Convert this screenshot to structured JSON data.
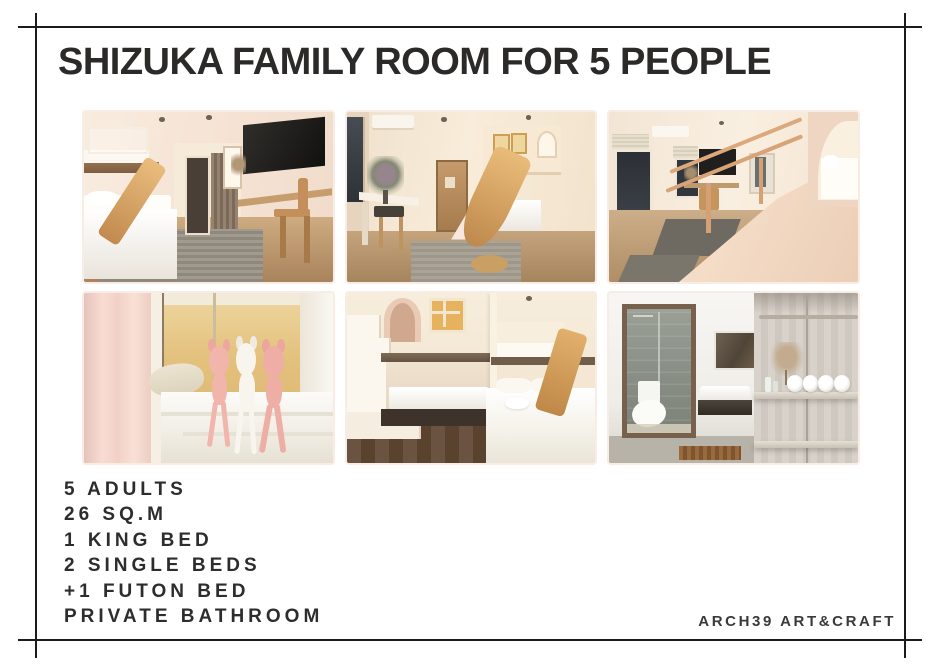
{
  "title": "SHIZUKA FAMILY ROOM FOR 5 PEOPLE",
  "specs": {
    "items": [
      "5 ADULTS",
      "26 SQ.M",
      "1 KING BED",
      "2 SINGLE BEDS",
      "+1 FUTON BED",
      "PRIVATE BATHROOM"
    ]
  },
  "brand": "ARCH39 ART&CRAFT",
  "photos": [
    {
      "description": "Bedroom with white king bed, loft bunk above, wooden slide, wall TV and work desk"
    },
    {
      "description": "Family room with dressing desk, wooden door, staircase to loft playhouse and large wooden slide"
    },
    {
      "description": "View from loft over wooden railing toward desk, TV and windows, with arched bed alcove"
    },
    {
      "description": "Three plush dolls sitting on a white bed against a warm yellow wall with pink curtain"
    },
    {
      "description": "Bunk beds with white staircase, arched doorway, paned window, king bed and wooden slide"
    },
    {
      "description": "Private bathroom with walk-in shower, toilet, washbasin and wooden shelf of rolled towels"
    }
  ],
  "colors": {
    "page-bg": "#ffffff",
    "frame-line": "#1b1b1b",
    "title-text": "#2b2a29",
    "spec-text": "#2d2d2d",
    "brand-text": "#3a3a3a",
    "wall-cream": "#f5e7d8",
    "wood-accent": "#d8a763",
    "floor-wood": "#c2a07b",
    "rug-gray": "#989186",
    "curtain-pink": "#f6dcd3",
    "wall-yellow": "#e3bd74",
    "bathroom-gray": "#8b9188",
    "shelf-wood": "#d2ccc5"
  }
}
